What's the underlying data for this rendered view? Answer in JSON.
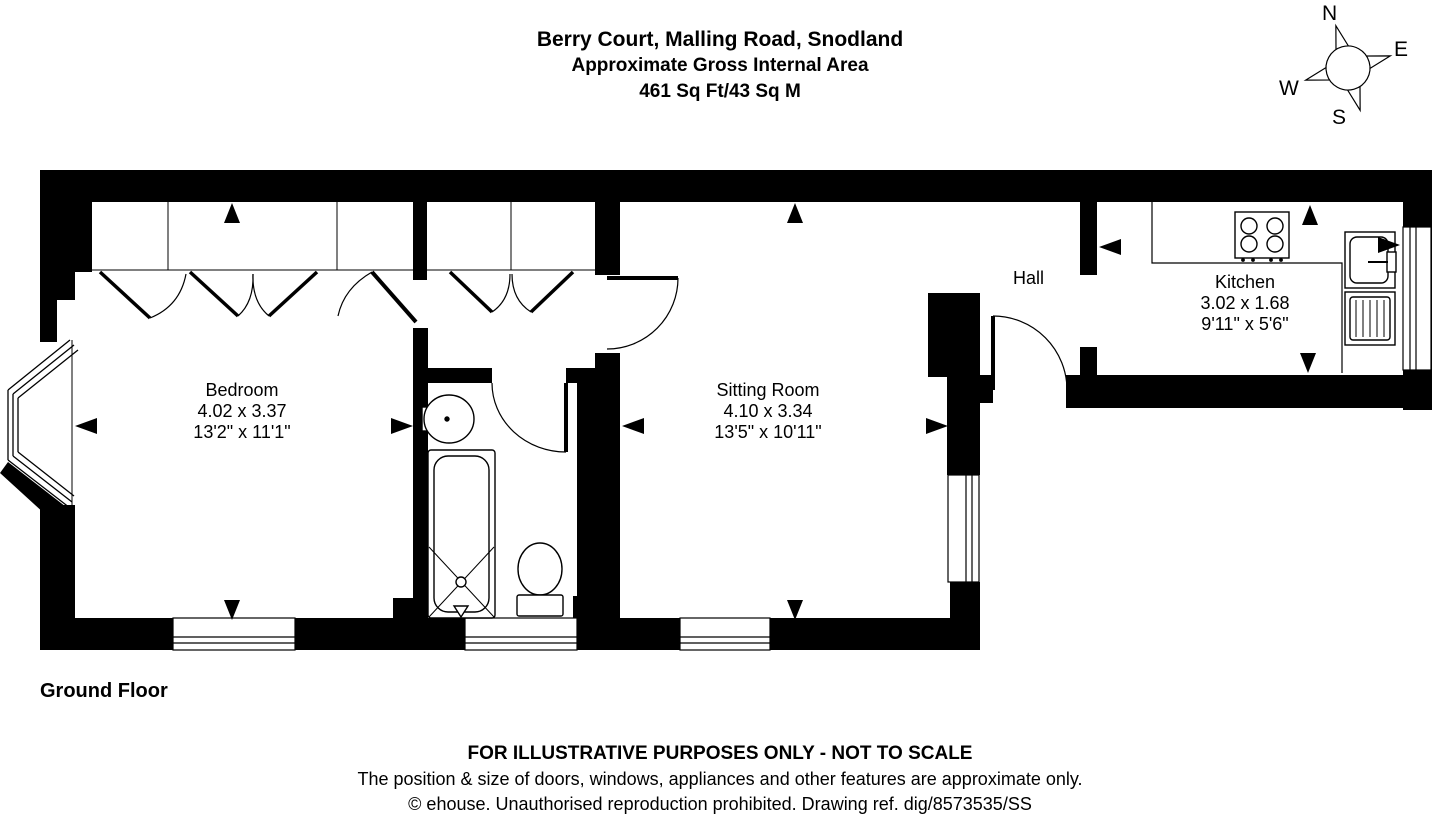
{
  "header": {
    "title": "Berry Court, Malling Road, Snodland",
    "subtitle": "Approximate Gross Internal Area",
    "area": "461 Sq Ft/43 Sq M"
  },
  "compass": {
    "n": "N",
    "e": "E",
    "s": "S",
    "w": "W"
  },
  "rooms": [
    {
      "name": "Bedroom",
      "metric": "4.02 x 3.37",
      "imperial": "13'2\" x 11'1\""
    },
    {
      "name": "Sitting Room",
      "metric": "4.10 x 3.34",
      "imperial": "13'5\" x 10'11\""
    },
    {
      "name": "Kitchen",
      "metric": "3.02 x 1.68",
      "imperial": "9'11\" x 5'6\""
    },
    {
      "name": "Hall"
    }
  ],
  "floor_label": "Ground Floor",
  "footer": {
    "line1": "FOR ILLUSTRATIVE PURPOSES ONLY - NOT TO SCALE",
    "line2": "The position & size of doors, windows, appliances and other features are approximate only.",
    "line3": "© ehouse. Unauthorised reproduction prohibited. Drawing ref. dig/8573535/SS"
  },
  "colors": {
    "wall": "#000000",
    "background": "#ffffff"
  }
}
